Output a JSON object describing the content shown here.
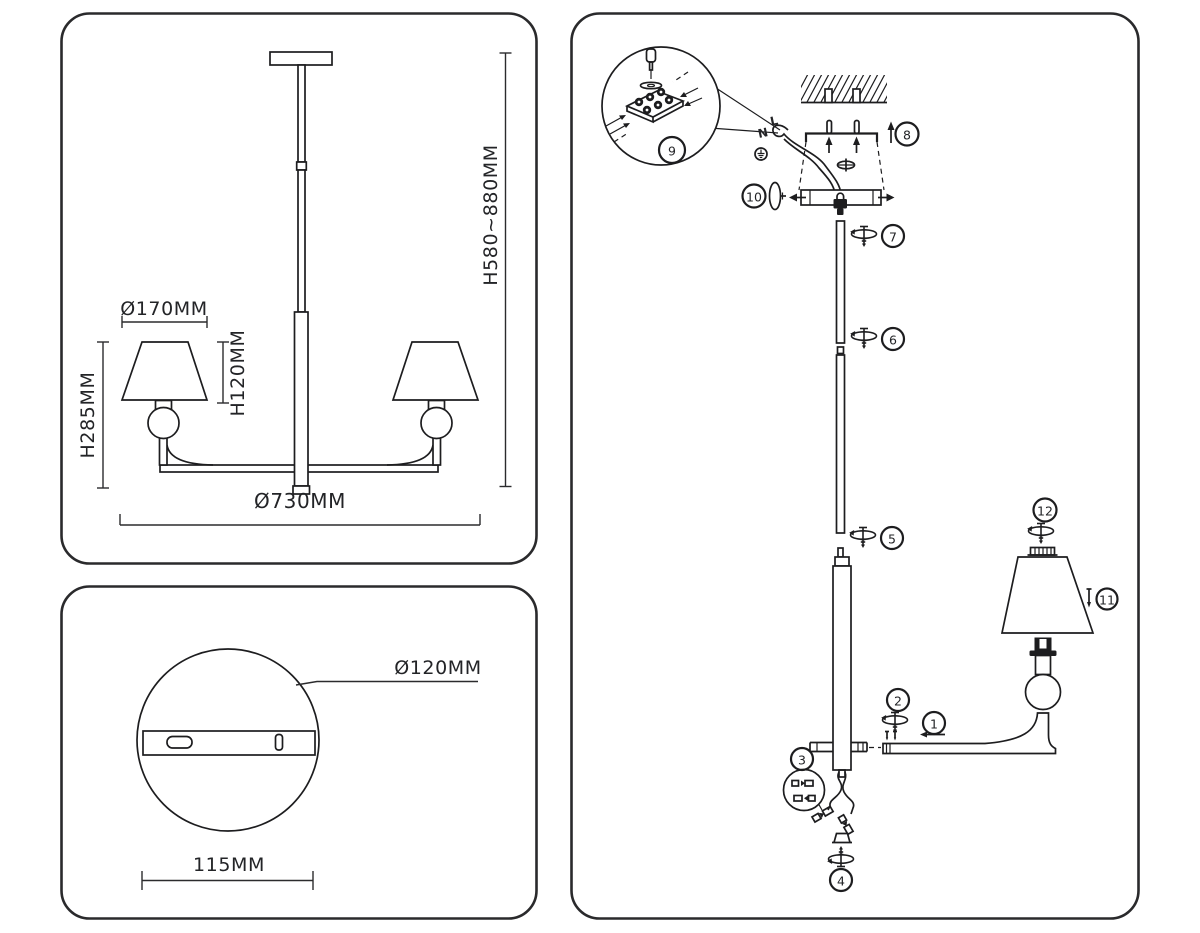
{
  "colors": {
    "line": "#1d1d1f",
    "background": "#ffffff"
  },
  "dimension_view": {
    "labels": {
      "shade_diameter": "Ø170MM",
      "shade_height": "H120MM",
      "body_height": "H285MM",
      "fixture_width": "Ø730MM",
      "overall_height": "H580~880MM"
    }
  },
  "mount_plate_view": {
    "labels": {
      "plate_diameter": "Ø120MM",
      "bracket_width": "115MM"
    }
  },
  "assembly_view": {
    "wire_labels": {
      "neutral": "N",
      "live": "L"
    },
    "callouts": [
      {
        "label": "1"
      },
      {
        "label": "2"
      },
      {
        "label": "3"
      },
      {
        "label": "4"
      },
      {
        "label": "5"
      },
      {
        "label": "6"
      },
      {
        "label": "7"
      },
      {
        "label": "8"
      },
      {
        "label": "9"
      },
      {
        "label": "10"
      },
      {
        "label": "11"
      },
      {
        "label": "12"
      }
    ]
  }
}
